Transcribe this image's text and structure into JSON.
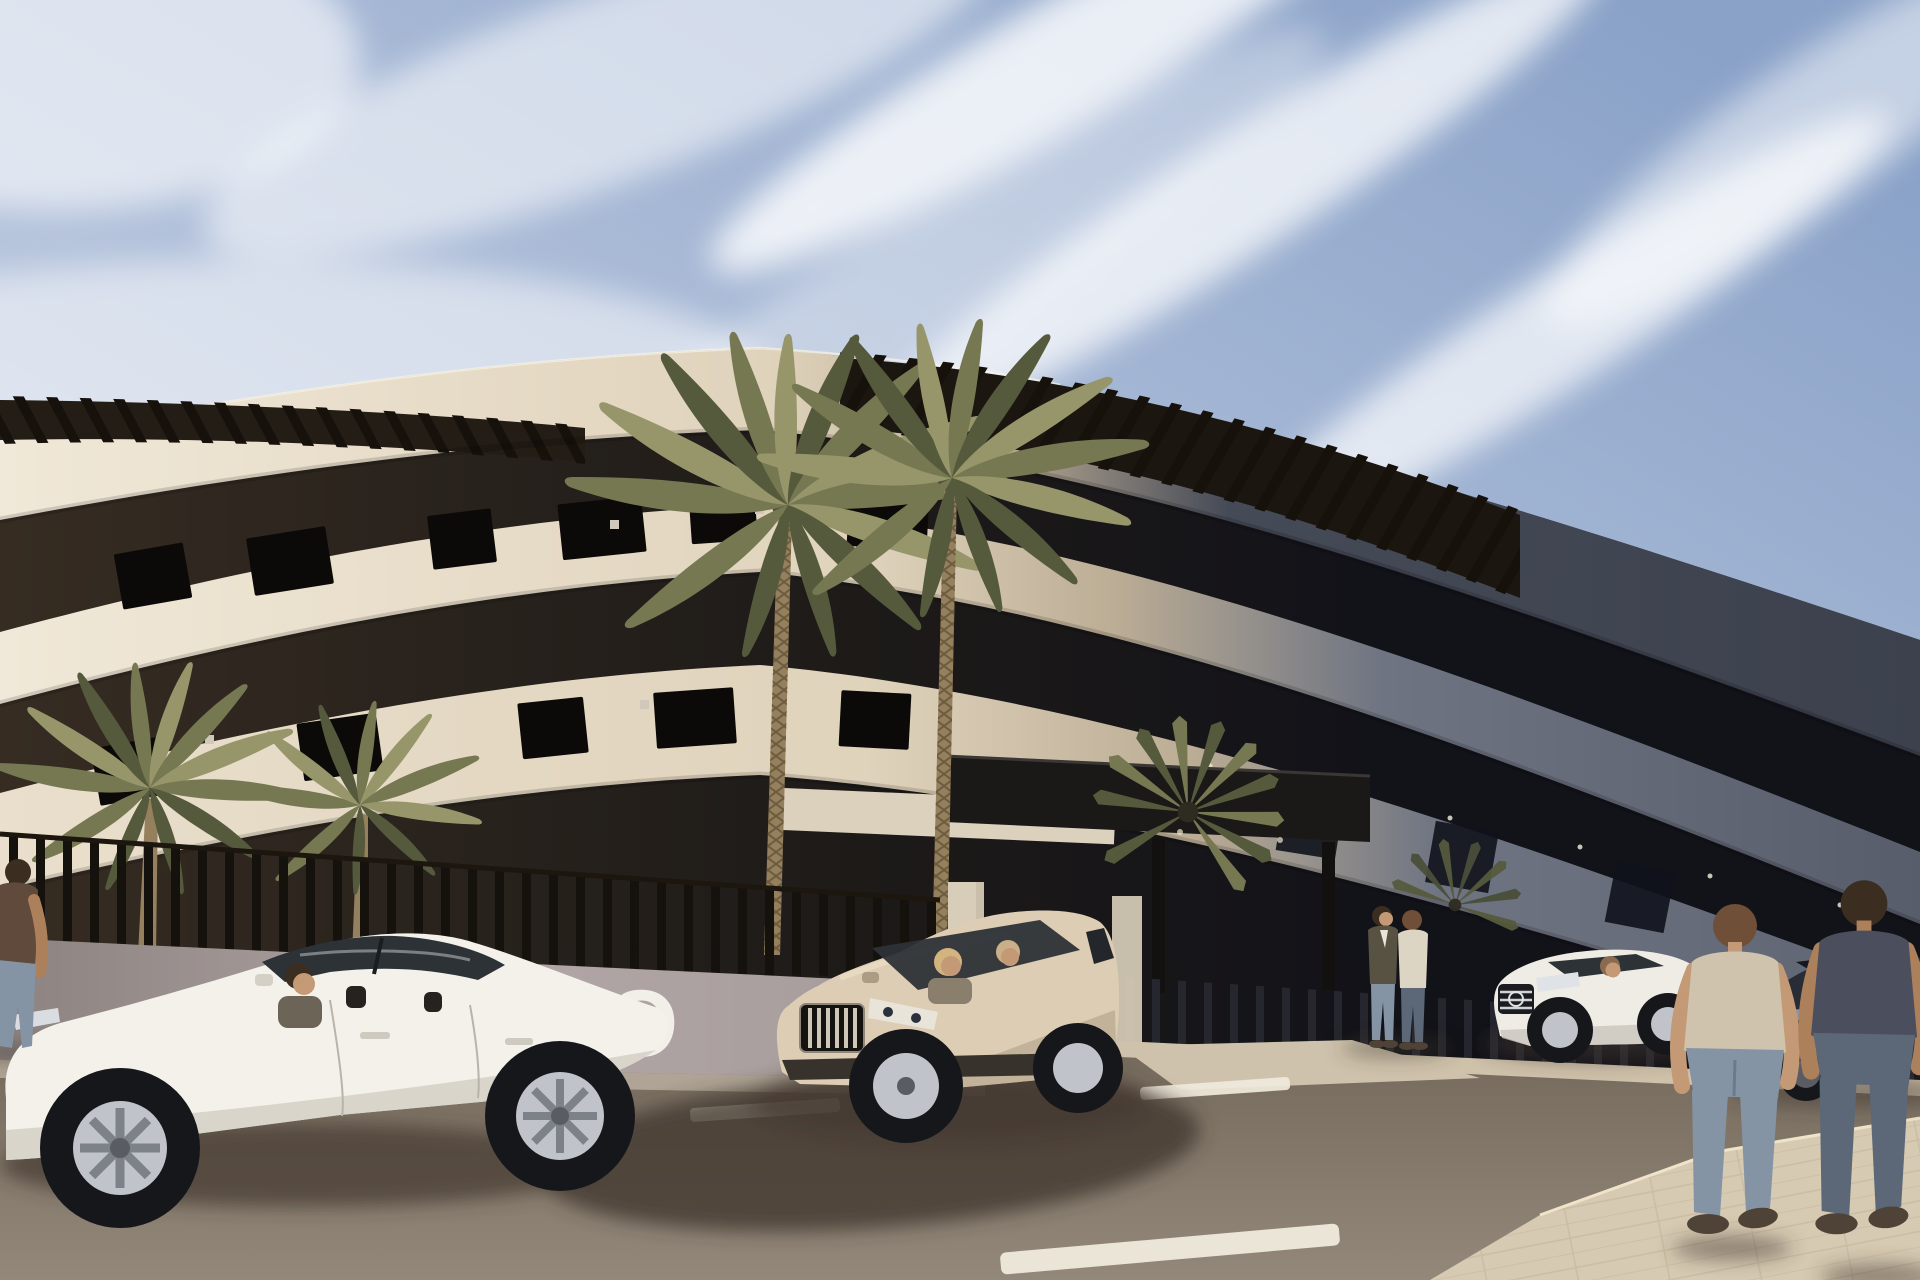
{
  "meta": {
    "title": "New-build apartment complex - street view architectural render",
    "type": "3D architectural visualization",
    "time_of_day": "sunny daytime",
    "sky": "light blue with diagonal wispy cirrus clouds"
  },
  "sign": {
    "visible_text": "TO",
    "description": "large white letters on perimeter wall, partially hidden behind parked white sedan"
  },
  "scene": {
    "building": "curved cream low-rise apartment block, dark recessed balcony strips, rooftop pergola slats, right third in shadow",
    "perimeter": "vertical black slat fence over mauve plinth wall, dark entrance canopy with posts",
    "vegetation": [
      "two tall date palms in front of facade",
      "two smaller palms at left inside fence",
      "fan palm at entrance",
      "fan palm behind white coupe"
    ],
    "vehicles": [
      {
        "id": "sedan-white",
        "description": "white sedan parked in foreground, driver inside"
      },
      {
        "id": "suv-champagne",
        "description": "champagne SUV with woman driver and passenger"
      },
      {
        "id": "sedan-mercedes",
        "description": "white saloon with chrome grille and star, driver inside"
      },
      {
        "id": "sedan-dark",
        "description": "dark grey saloon at far right"
      }
    ],
    "people": [
      {
        "id": "person-left-edge",
        "description": "man in dark tee cut off at left edge"
      },
      {
        "id": "entrance-pair",
        "description": "two men talking at the entrance walkway"
      },
      {
        "id": "walking-pair",
        "description": "two men walking away at right, beige tee and dark tee"
      }
    ],
    "road": {
      "lane_marking_count": 4,
      "surface": "brown asphalt",
      "sidewalk": "pale paved wedge bottom-right"
    }
  },
  "colors": {
    "sky_deep": "#8aa2c8",
    "sky_mid": "#b7c5dd",
    "sky_light": "#dde3ec",
    "cloud": "#ffffff",
    "facade_cream": "#f0e8d8",
    "facade_tan": "#e0d3bc",
    "facade_shade": "#bcad95",
    "facade_gray": "#6e7482",
    "facade_dark": "#454a57",
    "roof_dark": "#3c414d",
    "recess_brown": "#362c22",
    "recess_dark": "#1d1a18",
    "recess_black": "#121219",
    "pergola_slat": "#16110b",
    "fence_slat": "#15110c",
    "fence_slat_light": "#26262e",
    "fence_rail": "#1c160f",
    "wall_light": "#b2a7a6",
    "wall_dark": "#8c8280",
    "sign_text": "#f2efe9",
    "beam_cream": "#dcd1bc",
    "canopy_dark": "#1b1917",
    "pillar_cream": "#d8cdb8",
    "road_top": "#756a5c",
    "road_bottom": "#93887a",
    "lane_mark": "#f0eadc",
    "sidewalk_right": "#d7cab2",
    "sidewalk_left": "#b5aa9b",
    "kerb_light": "#cfc2ab",
    "walkway": "#cfc2ad",
    "shadow": "#42392f",
    "palm_light": "#97966b",
    "palm_mid": "#767852",
    "palm_dark": "#565a3c",
    "trunk": "#94805d",
    "trunk_line": "#6d5b3f",
    "car_white": "#f3f1ea",
    "car_white_shade": "#d4d0c6",
    "glass": "#2d3237",
    "glass_light": "#c9ced2",
    "suv_light": "#dccdb4",
    "suv_dark": "#ac9c84",
    "suv_clad": "#37332c",
    "merc_white": "#eeece5",
    "merc_shade": "#c9c6bc",
    "dark_car": "#282c34",
    "dark_car_glass": "#14171c",
    "tire": "#16171b",
    "rim": "#c0c4ca",
    "rim_dark": "#595d63",
    "skin": "#c49a76",
    "skin_shade": "#ad805c",
    "hair_brown": "#6f4f37",
    "hair_dark": "#3c2d21",
    "blonde": "#d3b47f",
    "tee_beige": "#cfc3ae",
    "tee_dark": "#4b4f5d",
    "tee_brown": "#5f4a3c",
    "jeans": "#8494a5",
    "jeans_dark": "#5c6878",
    "jacket_olive": "#585242",
    "jacket_cream": "#ddd5c3",
    "shoe": "#4f4337"
  }
}
